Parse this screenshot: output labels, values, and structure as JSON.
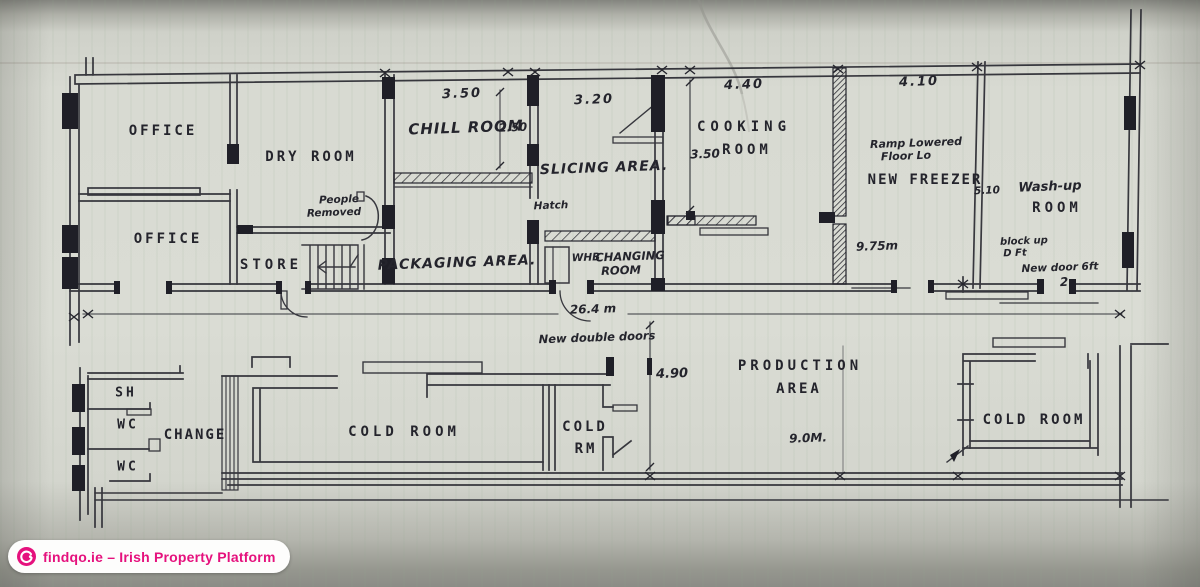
{
  "plan": {
    "rooms": {
      "office_top": "OFFICE",
      "office_bottom": "OFFICE",
      "dry_room": "DRY ROOM",
      "store": "STORE",
      "chill_room": "CHILL ROOM",
      "slicing_area": "SLICING AREA.",
      "packaging_area": "PACKAGING AREA.",
      "hatch": "Hatch",
      "whb": "WHB",
      "changing_line1": "CHANGING",
      "changing_line2": "ROOM",
      "cooking_line1": "COOKING",
      "cooking_line2": "ROOM",
      "new_freezer": "NEW FREEZER",
      "washup_line1": "Wash-up",
      "washup_line2": "ROOM",
      "production_line1": "PRODUCTION",
      "production_line2": "AREA",
      "cold_room_left": "COLD ROOM",
      "cold_rm_line1": "COLD",
      "cold_rm_line2": "RM",
      "cold_room_right": "COLD ROOM",
      "change": "CHANGE",
      "shower": "SH",
      "wc_top": "WC",
      "wc_bottom": "WC"
    },
    "dimensions": {
      "chill_width": "3.50",
      "chill_height": "2.50",
      "slicing_width": "3.20",
      "cooking_width": "4.40",
      "cooking_height": "3.50",
      "freezer_width": "4.10",
      "freezer_height": "5.10",
      "hall_length": "9.75m",
      "overall_length": "26.4 m",
      "production_width": "4.90",
      "production_length": "9.0M."
    },
    "annotations": {
      "people_line1": "People",
      "people_line2": "Removed",
      "freezer_note_line1": "Ramp Lowered",
      "freezer_note_line2": "Floor Lo",
      "block_up_line1": "block up",
      "block_up_line2": "D Ft",
      "new_door": "New door 6ft",
      "new_door_num": "2",
      "new_double_doors": "New double doors"
    }
  },
  "watermark": {
    "text": "findqo.ie – Irish Property Platform",
    "accent_color": "#e5117d"
  }
}
